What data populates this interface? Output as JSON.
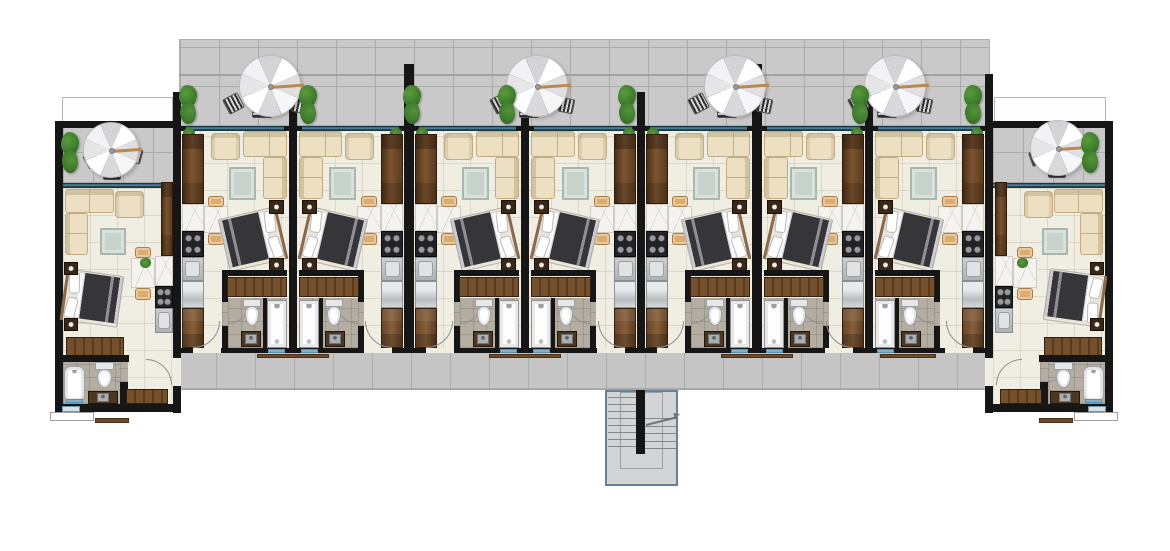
{
  "plan": {
    "type": "architectural-floor-plan",
    "visible_text": [],
    "canvas": {
      "w": 1170,
      "h": 551
    },
    "colors": {
      "wall": "#161616",
      "floor": "#f0ede3",
      "floor_line": "rgba(196,188,168,0.45)",
      "terrace": "#c9c9c9",
      "terrace_line": "rgba(148,148,148,0.55)",
      "corridor": "#c5c5c5",
      "window_teal": "#2a5a6d",
      "window_dark": "#173744",
      "wood_dark": "#4e3118",
      "wood_mid": "#7b5431",
      "cabinet": "#6b4526",
      "marble": "#f4f3ef",
      "stove": "#232327",
      "metal": "#b9bdc0",
      "sofa": "#ecdfc2",
      "sofa_edge": "#c3ac83",
      "rug": "#c9d3cd",
      "rug_edge": "#a9b8af",
      "bed_duvet": "#35353a",
      "nightstand": "#3a2817",
      "bath_floor": "#b4ada2",
      "fixture_edge": "#9aa0a4",
      "mat_blue": "#7fb0d0",
      "stair_fill": "#d2d4d6",
      "stair_edge": "#64809c",
      "plant_green": "#3f7d2d",
      "plant_dark": "#2a5a1c",
      "tan_chair": "#dcab6f",
      "umbrella_arm": "#b98a4e",
      "doormat": "#6d4a2c"
    },
    "terrace": {
      "x": 179,
      "y": 39,
      "w": 811,
      "h": 88,
      "rail_y": 74,
      "umbrella_groups": [
        270,
        537,
        735,
        895
      ],
      "planters": [
        188,
        308,
        412,
        507,
        627,
        860,
        973
      ]
    },
    "walls": [
      [
        173,
        92,
        8,
        321
      ],
      [
        289,
        92,
        8,
        261
      ],
      [
        404,
        64,
        10,
        289
      ],
      [
        521,
        92,
        8,
        261
      ],
      [
        637,
        92,
        8,
        261
      ],
      [
        752,
        64,
        10,
        289
      ],
      [
        865,
        92,
        8,
        261
      ],
      [
        985,
        74,
        8,
        339
      ],
      [
        55,
        121,
        8,
        292
      ],
      [
        55,
        121,
        118,
        7
      ],
      [
        55,
        404,
        126,
        8
      ],
      [
        993,
        121,
        120,
        7
      ],
      [
        1105,
        121,
        8,
        291
      ],
      [
        985,
        404,
        128,
        8
      ],
      [
        173,
        348,
        820,
        5
      ]
    ],
    "units": [
      {
        "id": "unit-1",
        "kind": "end-left",
        "x0": 55,
        "x1": 181
      },
      {
        "id": "unit-2",
        "kind": "A",
        "x0": 181,
        "x1": 289
      },
      {
        "id": "unit-3",
        "kind": "B",
        "x0": 297,
        "x1": 404
      },
      {
        "id": "unit-4",
        "kind": "A",
        "x0": 414,
        "x1": 521
      },
      {
        "id": "unit-5",
        "kind": "B",
        "x0": 529,
        "x1": 637
      },
      {
        "id": "unit-6",
        "kind": "A",
        "x0": 645,
        "x1": 752
      },
      {
        "id": "unit-7",
        "kind": "B",
        "x0": 762,
        "x1": 865
      },
      {
        "id": "unit-8",
        "kind": "B",
        "x0": 873,
        "x1": 985
      },
      {
        "id": "unit-9",
        "kind": "end-right",
        "x0": 985,
        "x1": 1113
      }
    ],
    "unit_rooms": [
      "living-area",
      "sleeping-area",
      "kitchenette",
      "bathroom"
    ],
    "corridor": {
      "x": 177,
      "y": 353,
      "w": 810,
      "h": 37
    },
    "doormats": [
      [
        257,
        354,
        72,
        4
      ],
      [
        489,
        354,
        72,
        4
      ],
      [
        721,
        354,
        72,
        4
      ],
      [
        880,
        354,
        56,
        4
      ]
    ],
    "stair": {
      "x": 605,
      "y": 390,
      "w": 73,
      "h": 96
    },
    "balcony_left": {
      "railing": [
        62,
        97,
        111,
        25
      ],
      "deck": [
        63,
        121,
        110,
        62
      ],
      "window": [
        63,
        183,
        110,
        5
      ],
      "umbrella": {
        "cx": 111,
        "cy": 150,
        "d": 56
      },
      "planter_x": 70
    },
    "balcony_right": {
      "railing": [
        994,
        97,
        112,
        25
      ],
      "deck": [
        993,
        121,
        112,
        62
      ],
      "window": [
        993,
        183,
        112,
        5
      ],
      "umbrella": {
        "cx": 1058,
        "cy": 148,
        "d": 56
      },
      "planter_x": 1090
    },
    "porches": {
      "left_step": [
        50,
        412,
        44,
        9
      ],
      "left_mat": [
        95,
        418,
        34,
        5
      ],
      "right_step": [
        1074,
        412,
        44,
        9
      ],
      "right_mat": [
        1039,
        418,
        34,
        5
      ],
      "left_window": [
        62,
        406,
        18,
        6
      ],
      "right_window": [
        1088,
        406,
        18,
        6
      ]
    }
  }
}
